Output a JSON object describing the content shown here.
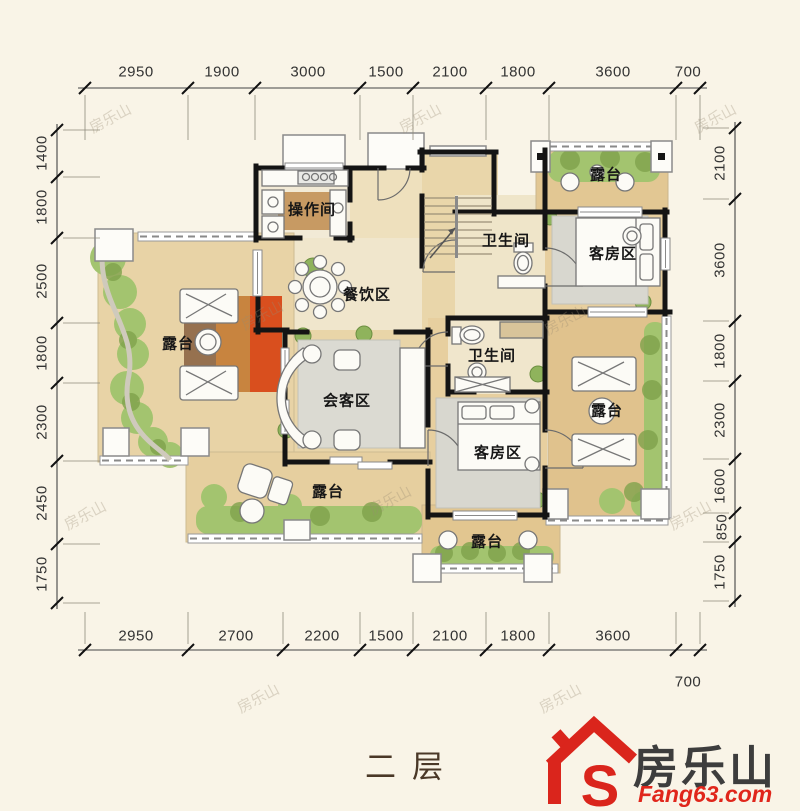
{
  "title": "二层",
  "watermark": "房乐山",
  "logo": {
    "brand": "房乐山",
    "domain": "Fang63.com",
    "monogram": "S",
    "red": "#da251c",
    "dark": "#3d3d3d"
  },
  "dims": {
    "top": [
      "2950",
      "1900",
      "3000",
      "1500",
      "2100",
      "1800",
      "3600",
      "700"
    ],
    "bottom": [
      "2950",
      "2700",
      "2200",
      "1500",
      "2100",
      "1800",
      "3600"
    ],
    "bottom_offset": "700",
    "left": [
      "1400",
      "1800",
      "2500",
      "1800",
      "2300",
      "2450",
      "1750"
    ],
    "right": [
      "2100",
      "3600",
      "1800",
      "2300",
      "1600",
      "850",
      "1750"
    ]
  },
  "rooms": {
    "kitchen": "操作间",
    "dining": "餐饮区",
    "bath1": "卫生间",
    "bath2": "卫生间",
    "guest1": "客房区",
    "guest2": "客房区",
    "living": "会客区",
    "terrace_tr": "露台",
    "terrace_left": "露台",
    "terrace_right": "露台",
    "terrace_bottom": "露台",
    "terrace_bottom_mid": "露台"
  },
  "colors": {
    "background": "#f9f4e7",
    "wall": "#141414",
    "wood_floor": "#ecd9b0",
    "terrace_floor": "#e3c897",
    "grass": "#a3c46f",
    "rug_gray": "#d9d8d0",
    "rug_orange": "#d4622a",
    "dim_text": "#333333"
  }
}
